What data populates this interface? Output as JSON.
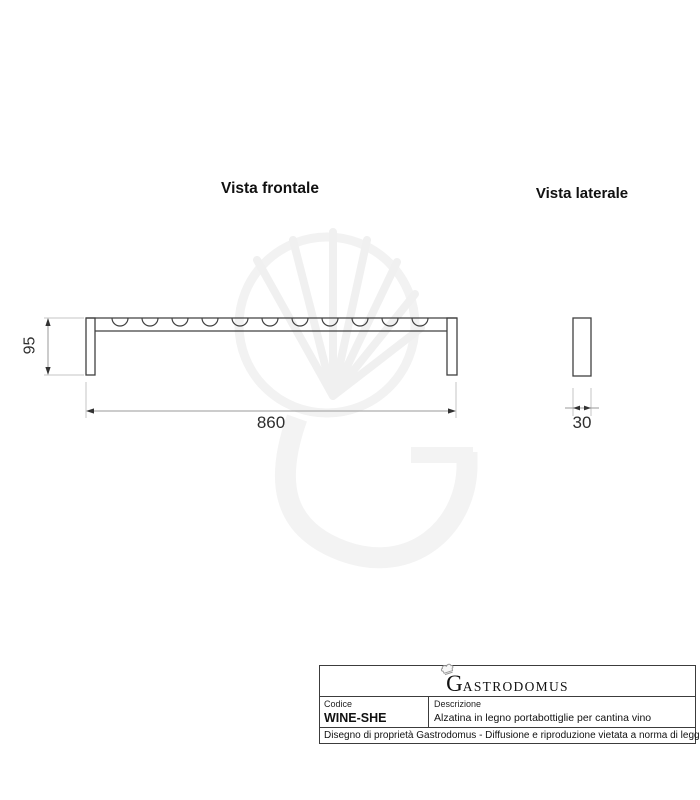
{
  "headings": {
    "frontal": "Vista frontale",
    "lateral": "Vista laterale"
  },
  "views": {
    "frontal": {
      "width_label": "860",
      "height_label": "95",
      "notch_count": 11
    },
    "lateral": {
      "depth_label": "30"
    }
  },
  "title_block": {
    "brand": {
      "initial": "G",
      "rest": "ASTRODOMUS"
    },
    "code_label": "Codice",
    "code_value": "WINE-SHE",
    "description_label": "Descrizione",
    "description_value": "Alzatina in legno portabottiglie per cantina vino",
    "legal": "Disegno di proprietà Gastrodomus - Diffusione e riproduzione vietata a norma di legge."
  },
  "colors": {
    "drawing_line": "#404040",
    "dimension_line": "#9a9a9a",
    "extension_line": "#c6c6c6",
    "arrow": "#333333",
    "watermark": "#f2f2f2",
    "text": "#1a1a1a"
  }
}
